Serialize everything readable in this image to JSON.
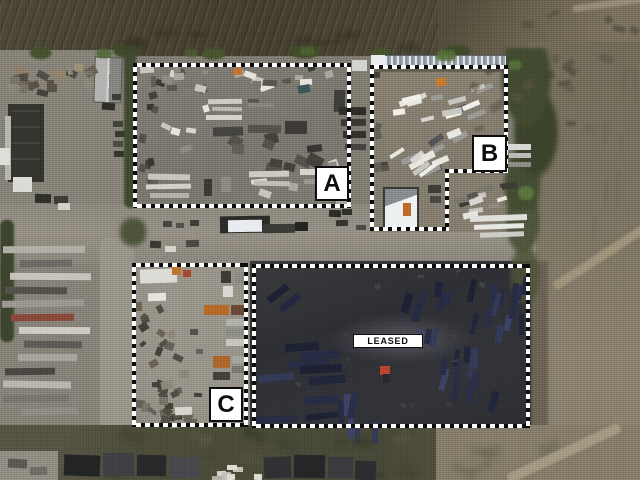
{
  "parcels": [
    {
      "id": "A",
      "label": "A"
    },
    {
      "id": "B",
      "label": "B"
    },
    {
      "id": "C",
      "label": "C"
    },
    {
      "id": "LEASED",
      "label": "LEASED"
    }
  ],
  "colors": {
    "outline_dash_dark": "#0c0c0c",
    "outline_dash_light": "#fdfdfd",
    "label_background": "#ffffff",
    "label_text": "#0d0d0d",
    "label_border": "#0d0d0d"
  }
}
